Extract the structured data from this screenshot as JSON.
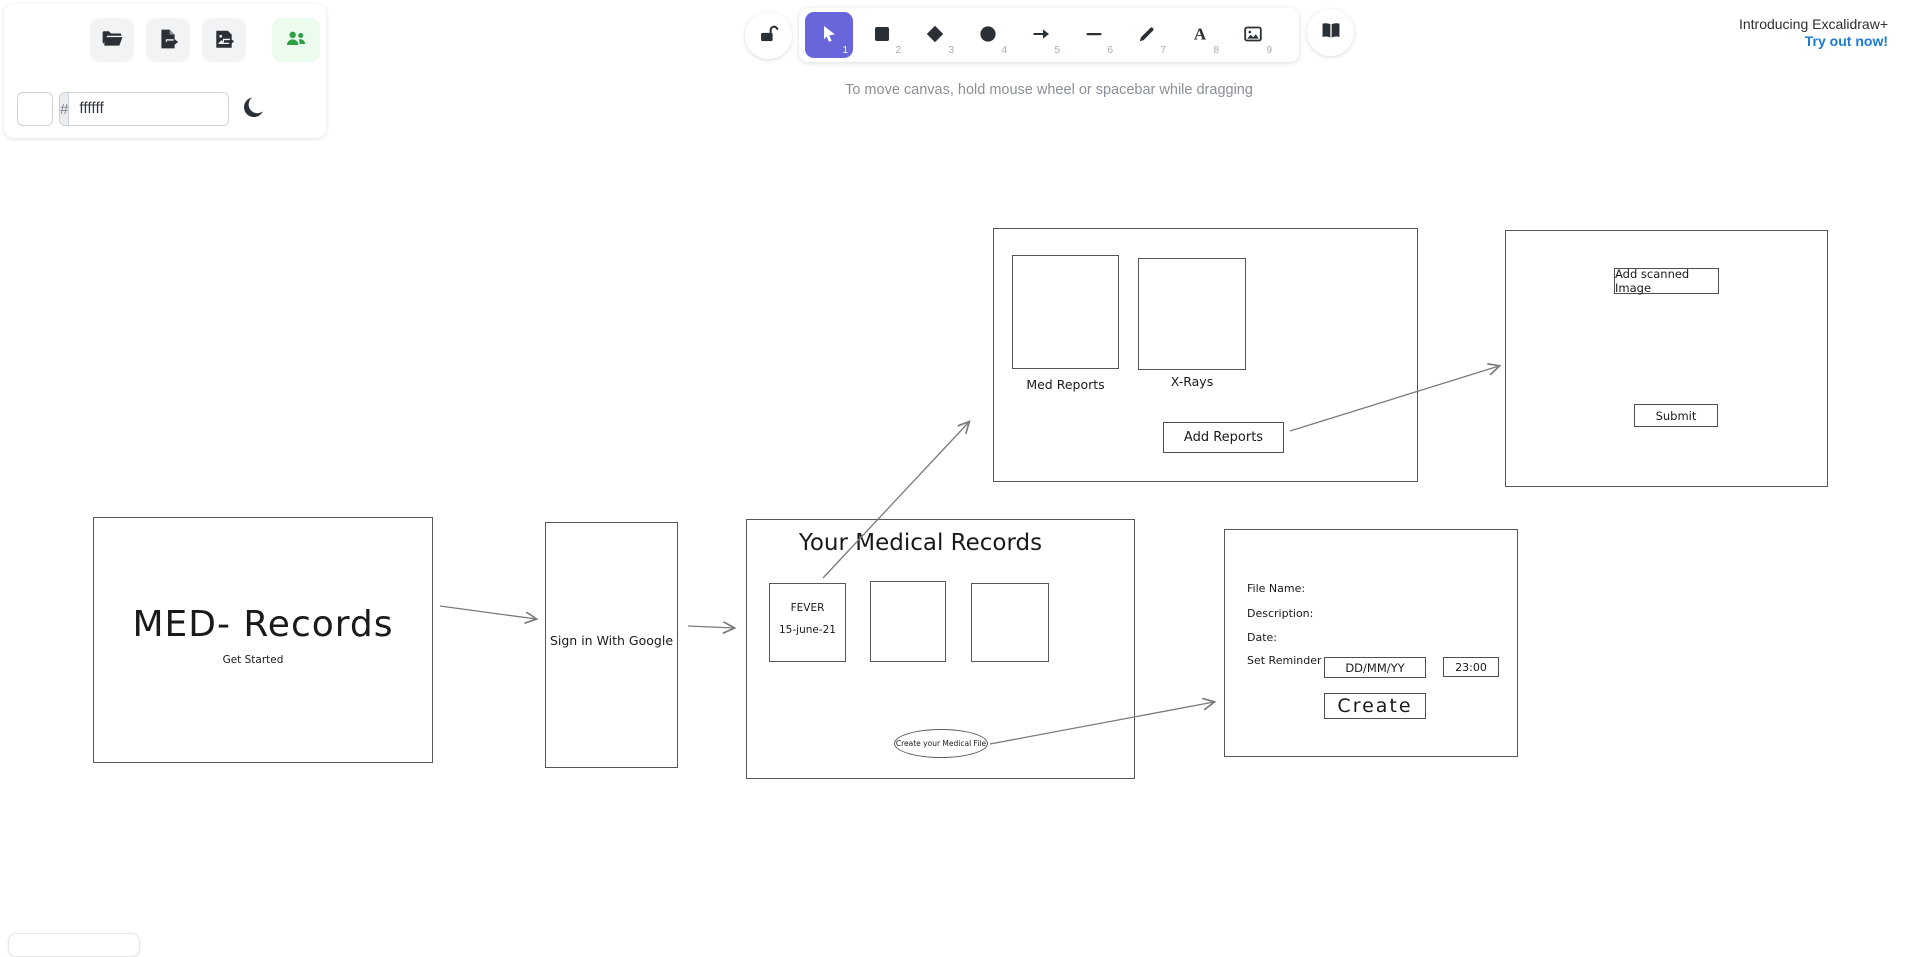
{
  "promo": {
    "line1": "Introducing Excalidraw+",
    "line2": "Try out now!"
  },
  "hint": "To move canvas, hold mouse wheel or spacebar while dragging",
  "left_panel": {
    "hash_prefix": "#",
    "canvas_background_value": "ffffff",
    "buttons": [
      {
        "icon": "folder-open-icon"
      },
      {
        "icon": "file-export-icon"
      },
      {
        "icon": "image-export-icon"
      },
      {
        "icon": "collaborators-icon"
      }
    ],
    "theme_toggle_icon": "moon-icon"
  },
  "toolbar": {
    "lock_icon": "lock-open-icon",
    "library_icon": "book-icon",
    "tools": [
      {
        "name": "selection",
        "shortcut": "1",
        "active": true
      },
      {
        "name": "rectangle",
        "shortcut": "2",
        "active": false
      },
      {
        "name": "diamond",
        "shortcut": "3",
        "active": false
      },
      {
        "name": "ellipse",
        "shortcut": "4",
        "active": false
      },
      {
        "name": "arrow",
        "shortcut": "5",
        "active": false
      },
      {
        "name": "line",
        "shortcut": "6",
        "active": false
      },
      {
        "name": "draw",
        "shortcut": "7",
        "active": false
      },
      {
        "name": "text",
        "shortcut": "8",
        "active": false
      },
      {
        "name": "image",
        "shortcut": "9",
        "active": false
      }
    ]
  },
  "colors": {
    "accent": "#6965db",
    "promo_link": "#1a7ad4",
    "collaborators_green": "#2f9e44",
    "collaborators_green_bg": "#ebfbee",
    "canvas_stroke": "#575757",
    "arrow_stroke": "#7a7a7a",
    "hint_text": "#8a8f98"
  },
  "diagram": {
    "med_box": {
      "title": "MED- Records",
      "subtitle": "Get Started"
    },
    "signin_box": {
      "label": "Sign in With Google"
    },
    "records_box": {
      "title": "Your Medical Records",
      "card1_line1": "FEVER",
      "card1_line2": "15-june-21",
      "ellipse_label": "Create your Medical File"
    },
    "reports_box": {
      "thumb1_label": "Med Reports",
      "thumb2_label": "X-Rays",
      "button_label": "Add Reports"
    },
    "scan_box": {
      "button1_label": "Add scanned Image",
      "button2_label": "Submit"
    },
    "form_box": {
      "label1": "File Name:",
      "label2": "Description:",
      "label3": "Date:",
      "label4": "Set Reminder",
      "date_value": "DD/MM/YY",
      "time_value": "23:00",
      "button_label": "Create"
    }
  }
}
